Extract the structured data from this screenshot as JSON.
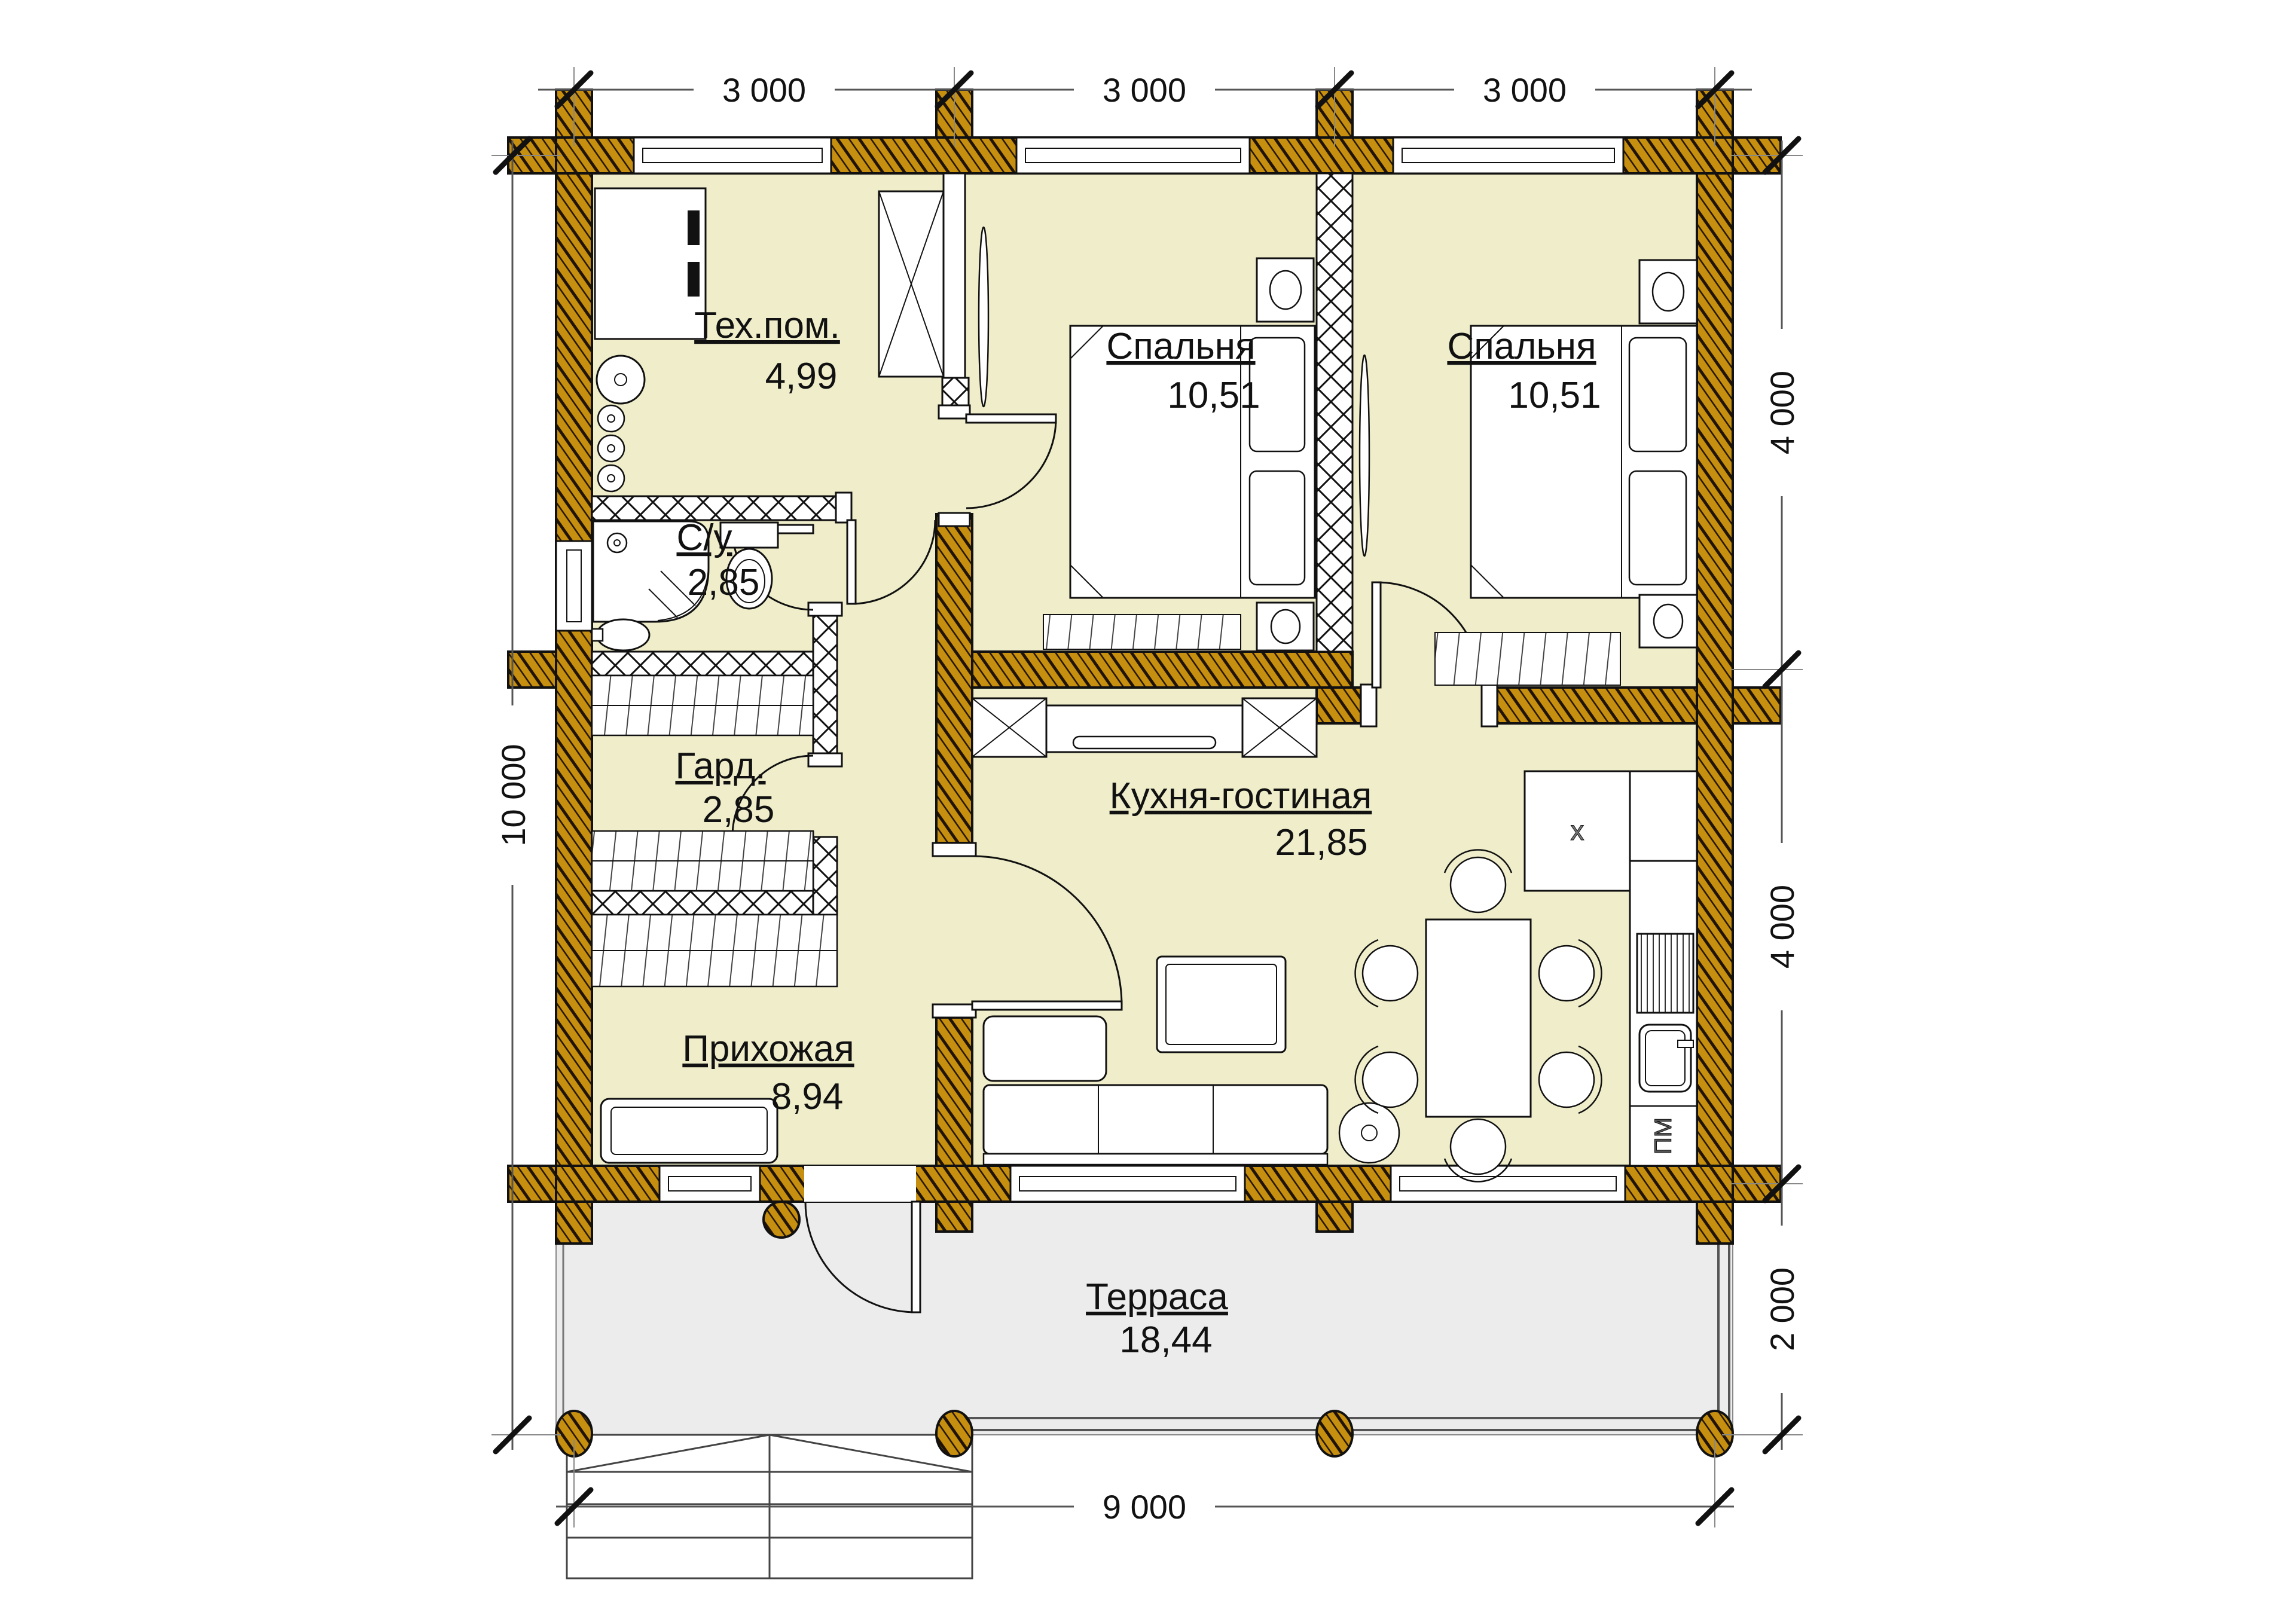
{
  "rooms": {
    "tech": {
      "name": "Тех.пом.",
      "area": "4,99"
    },
    "bedroom1": {
      "name": "Спальня",
      "area": "10,51"
    },
    "bedroom2": {
      "name": "Спальня",
      "area": "10,51"
    },
    "bathroom": {
      "name": "С/у",
      "area": "2,85"
    },
    "wardrobe": {
      "name": "Гард.",
      "area": "2,85"
    },
    "hallway": {
      "name": "Прихожая",
      "area": "8,94"
    },
    "kitchen": {
      "name": "Кухня-гостиная",
      "area": "21,85"
    },
    "terrace": {
      "name": "Терраса",
      "area": "18,44"
    }
  },
  "dimensions": {
    "top": [
      "3 000",
      "3 000",
      "3 000"
    ],
    "left": "10 000",
    "right": [
      "4 000",
      "4 000",
      "2 000"
    ],
    "bottom": "9 000"
  },
  "marks": {
    "dishwasher": "ПМ",
    "fridge": "x"
  },
  "colors": {
    "wood": "#c78f10",
    "room_fill": "#efedca",
    "terrace_fill": "#ececec",
    "line": "#111111"
  }
}
